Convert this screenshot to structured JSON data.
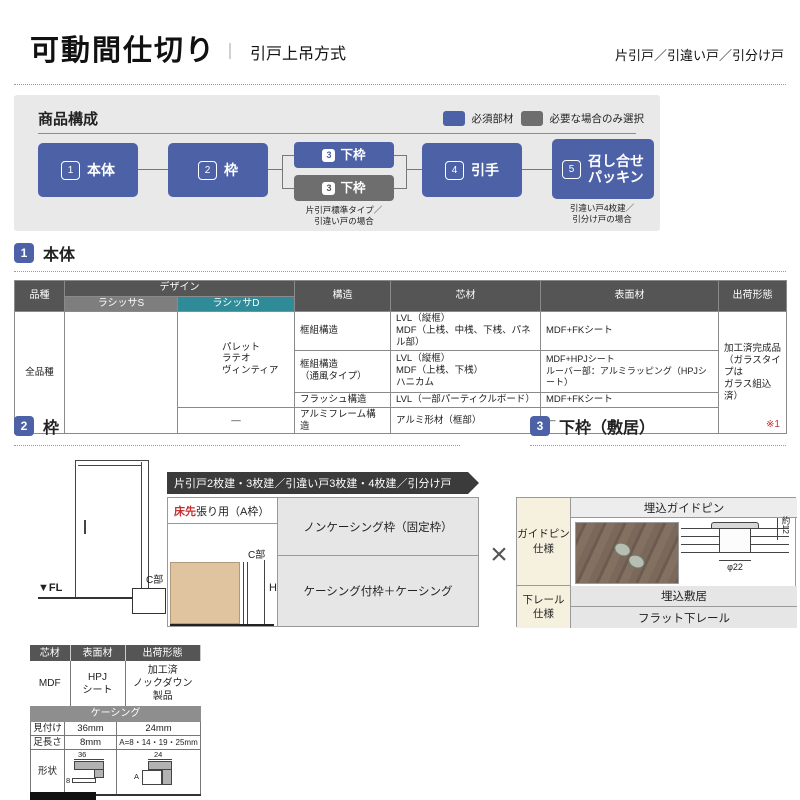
{
  "colors": {
    "accent": "#4d61a6",
    "muted": "#6e6e6e",
    "teal": "#2f8b97",
    "red": "#c53030",
    "header-dark": "#555555",
    "panel": "#e9e9e9",
    "cell": "#e6e6e6",
    "cream": "#f6f1de",
    "tan": "#e0c4a0"
  },
  "header": {
    "title": "可動間仕切り",
    "separator": "｜",
    "subtitle": "引戸上吊方式",
    "door_types": "片引戸／引違い戸／引分け戸"
  },
  "composition": {
    "title": "商品構成",
    "legend": [
      {
        "label": "必須部材"
      },
      {
        "label": "必要な場合のみ選択"
      }
    ],
    "boxes": {
      "b1": {
        "num": "1",
        "label": "本体"
      },
      "b2": {
        "num": "2",
        "label": "枠"
      },
      "b3a": {
        "num": "3",
        "label": "下枠"
      },
      "b3b": {
        "num": "3",
        "label": "下枠",
        "note": "片引戸標準タイプ／\n引違い戸の場合"
      },
      "b4": {
        "num": "4",
        "label": "引手"
      },
      "b5": {
        "num": "5",
        "label": "召し合せ\nパッキン",
        "note": "引違い戸4枚建／\n引分け戸の場合"
      }
    }
  },
  "body_section": {
    "num": "1",
    "title": "本体",
    "table": {
      "h_hinshu": "品種",
      "h_design": "デザイン",
      "h_lasissa_s": "ラシッサS",
      "h_lasissa_d": "ラシッサD",
      "h_kozo": "構造",
      "h_shinzai": "芯材",
      "h_hyomenzai": "表面材",
      "h_shukka": "出荷形態",
      "hinshu": "全品種",
      "lasissa_s": "",
      "lasissa_d": "パレット\nラテオ\nヴィンティア",
      "lasissa_d_alumi": "―",
      "rows": [
        {
          "kozo": "框組構造",
          "shinzai": "LVL（縦框）\nMDF（上桟、中桟、下桟、パネル部）",
          "hyomenzai": "MDF+FKシート"
        },
        {
          "kozo": "框組構造\n（通風タイプ）",
          "shinzai": "LVL（縦框）\nMDF（上桟、下桟）\nハニカム",
          "hyomenzai": "MDF+HPJシート\nルーバー部：アルミラッピング（HPJシート）"
        },
        {
          "kozo": "フラッシュ構造",
          "shinzai": "LVL（一部パーティクルボード）",
          "hyomenzai": "MDF+FKシート"
        },
        {
          "kozo": "アルミフレーム構造",
          "shinzai": "アルミ形材（框部）",
          "hyomenzai": "―"
        }
      ],
      "shukka": "加工済完成品\n（ガラスタイプは\nガラス組込済）"
    }
  },
  "frame_section": {
    "num": "2",
    "title": "枠",
    "fl_label": "▼FL",
    "c_label": "C部",
    "banner": "片引戸2枚建・3枚建／引違い戸3枚建・4枚建／引分け戸",
    "floor_first": "床先",
    "floor_rest": "張り用（A枠）",
    "c_label2": "C部",
    "h_label": "H",
    "option1": "ノンケーシング枠（固定枠）",
    "option2": "ケーシング付枠＋ケーシング",
    "multiply": "×"
  },
  "sill_section": {
    "num": "3",
    "title": "下枠（敷居）",
    "note": "※1",
    "guide_row_header": "ガイドピン\n仕様",
    "guide_title": "埋込ガイドピン",
    "dim_height": "約12",
    "dim_dia": "φ22",
    "rail_row_header": "下レール\n仕様",
    "rail1": "埋込敷居",
    "rail2": "フラット下レール"
  },
  "frame_spec_table": {
    "h1": "芯材",
    "h2": "表面材",
    "h3": "出荷形態",
    "v1": "MDF",
    "v2": "HPJ\nシート",
    "v3": "加工済\nノックダウン\n製品"
  },
  "casing_table": {
    "title": "ケーシング",
    "r1_label": "見付け",
    "r1_v1": "36mm",
    "r1_v2": "24mm",
    "r2_label": "足長さ",
    "r2_v1": "8mm",
    "r2_v2": "A=8・14・19・25mm",
    "r3_label": "形状",
    "s1_w": "36",
    "s1_h": "8",
    "s2_w": "24",
    "s2_h": "A"
  }
}
